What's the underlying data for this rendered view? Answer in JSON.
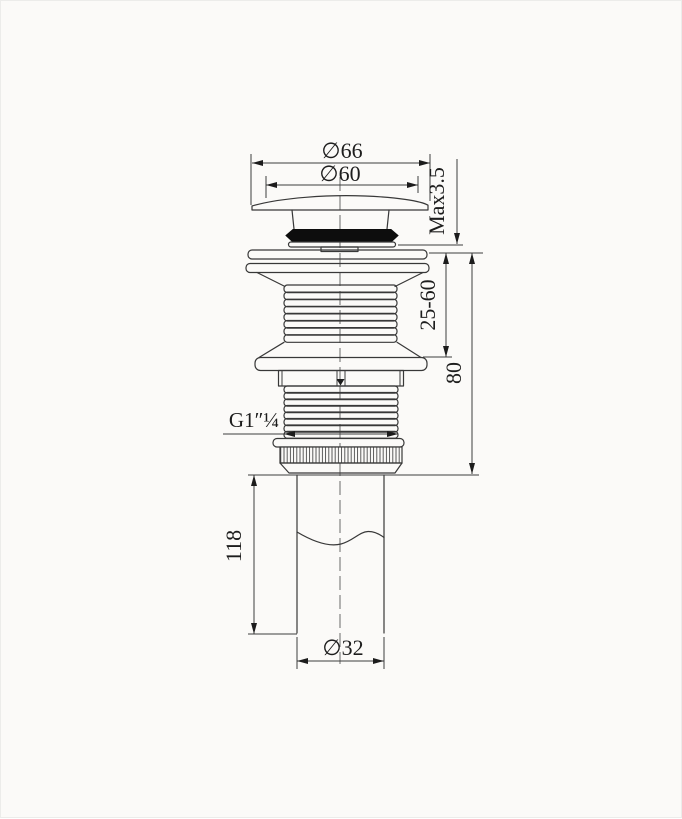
{
  "meta": {
    "title": "Pop-up basin waste dimensional drawing"
  },
  "colors": {
    "background": "#fbfaf8",
    "line": "#383838",
    "gasket_fill": "#0d0d0d"
  },
  "dimensions": {
    "cap_outer_diameter": "∅66",
    "cap_inner_diameter": "∅60",
    "cap_max_height": "Max3.5",
    "clamp_range": "25-60",
    "body_height": "80",
    "thread_spec": "G1″¼",
    "tailpipe_length": "118",
    "tailpipe_diameter": "∅32"
  },
  "components": {
    "cap": "dome cap",
    "gasket": "rubber seal",
    "flange": "top flange",
    "upper_thread": "upper thread",
    "locking_disc": "flange disc",
    "lower_thread": "lower thread",
    "knurled_nut": "knurled nut",
    "tailpipe": "tail pipe"
  }
}
